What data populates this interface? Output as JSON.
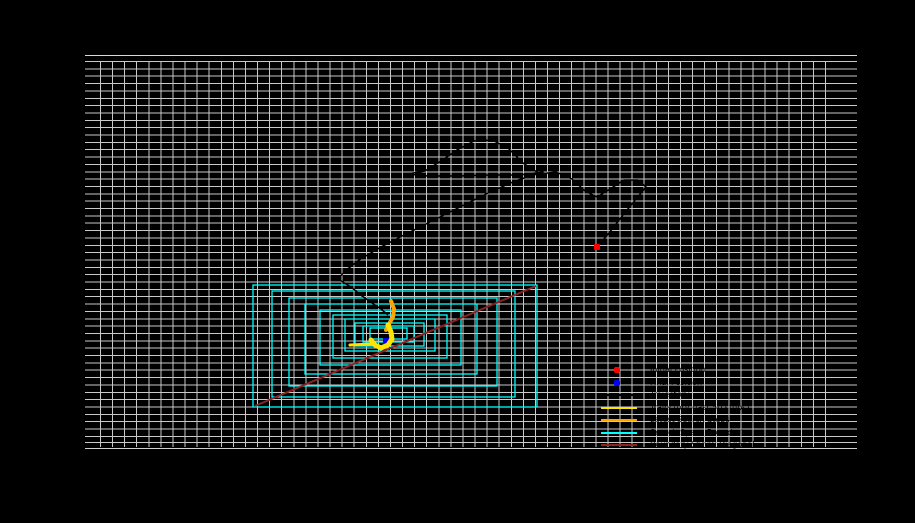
{
  "canvas": {
    "width": 915,
    "height": 523,
    "background": "#000000"
  },
  "plot": {
    "left": 85,
    "top": 55,
    "width": 772,
    "height": 394,
    "grid_color": "#c9c9c9",
    "spine_color": "#d9d9d9",
    "grid_dx": 12.083,
    "grid_dy": 7.35
  },
  "chart_data": {
    "type": "line",
    "title": "",
    "xlabel": "",
    "ylabel": "",
    "grid": true,
    "legend_position": "lower right",
    "text_visibility_note": "all axis/tick/legend text is rendered black on a black background (visible only as silhouettes over gridlines)",
    "colors": {
      "search_boundary": "#00ffff",
      "boundary_diagonal": "#8b2323",
      "trajectory": "#000000",
      "trajectory_recent_yellow": "#ffe400",
      "trajectory_recent_orange": "#ffa500",
      "initial_position": "#ff0000",
      "final_position": "#0000ff"
    },
    "initial_position_px": [
      597,
      247
    ],
    "final_position_px": [
      386,
      341
    ],
    "boundary_rects_px": [
      [
        253,
        285,
        284,
        122
      ],
      [
        272,
        291,
        243,
        106
      ],
      [
        289,
        298,
        208,
        88
      ],
      [
        305,
        304,
        172,
        70
      ],
      [
        320,
        310,
        141,
        55
      ],
      [
        333,
        315,
        114,
        43
      ],
      [
        345,
        319,
        90,
        32
      ],
      [
        355,
        323,
        69,
        23
      ],
      [
        363,
        326,
        51,
        16
      ],
      [
        370,
        328,
        37,
        11
      ]
    ],
    "boundary_diagonal_px": [
      [
        255,
        406
      ],
      [
        536,
        286
      ]
    ],
    "trajectory_px": [
      [
        597,
        247
      ],
      [
        609,
        233
      ],
      [
        623,
        215
      ],
      [
        636,
        199
      ],
      [
        646,
        187
      ],
      [
        638,
        180
      ],
      [
        624,
        180
      ],
      [
        610,
        189
      ],
      [
        597,
        197
      ],
      [
        585,
        191
      ],
      [
        572,
        179
      ],
      [
        556,
        172
      ],
      [
        540,
        174
      ],
      [
        523,
        163
      ],
      [
        508,
        148
      ],
      [
        492,
        140
      ],
      [
        474,
        141
      ],
      [
        457,
        150
      ],
      [
        441,
        161
      ],
      [
        425,
        171
      ],
      [
        407,
        174
      ],
      [
        428,
        176
      ],
      [
        458,
        176
      ],
      [
        490,
        175
      ],
      [
        519,
        175
      ],
      [
        543,
        172
      ],
      [
        515,
        181
      ],
      [
        486,
        194
      ],
      [
        458,
        208
      ],
      [
        432,
        221
      ],
      [
        406,
        234
      ],
      [
        381,
        247
      ],
      [
        359,
        260
      ],
      [
        345,
        271
      ],
      [
        338,
        279
      ],
      [
        351,
        287
      ],
      [
        362,
        296
      ],
      [
        372,
        303
      ],
      [
        381,
        309
      ],
      [
        388,
        315
      ]
    ],
    "trajectory_recent_orange_px": [
      [
        391,
        301
      ],
      [
        394,
        309
      ],
      [
        393,
        317
      ],
      [
        389,
        324
      ],
      [
        386,
        330
      ]
    ],
    "trajectory_recent_yellow_px": [
      [
        388,
        325
      ],
      [
        391,
        332
      ],
      [
        392,
        339
      ],
      [
        388,
        345
      ],
      [
        381,
        348
      ],
      [
        375,
        345
      ],
      [
        371,
        340
      ]
    ],
    "trajectory_yellow_tail_px": [
      [
        373,
        344
      ],
      [
        350,
        345
      ]
    ]
  },
  "legend": {
    "label_color": "#000000",
    "items": [
      {
        "marker": "dot",
        "color": "#ff0000",
        "label": "Initial Position"
      },
      {
        "marker": "dot",
        "color": "#0000ff",
        "label": "Final Position"
      },
      {
        "marker": "line",
        "color": "#000000",
        "label": "Trajectory"
      },
      {
        "marker": "line",
        "color": "#ffe400",
        "label": "Trajectory (last 50 steps)"
      },
      {
        "marker": "line",
        "color": "#ffa500",
        "label": "Latest Search Steps"
      },
      {
        "marker": "line",
        "color": "#00ffff",
        "label": "Search Space Boundaries"
      },
      {
        "marker": "line",
        "color": "#8b2323",
        "label": "Boundary Shrink Diagonal"
      }
    ]
  }
}
